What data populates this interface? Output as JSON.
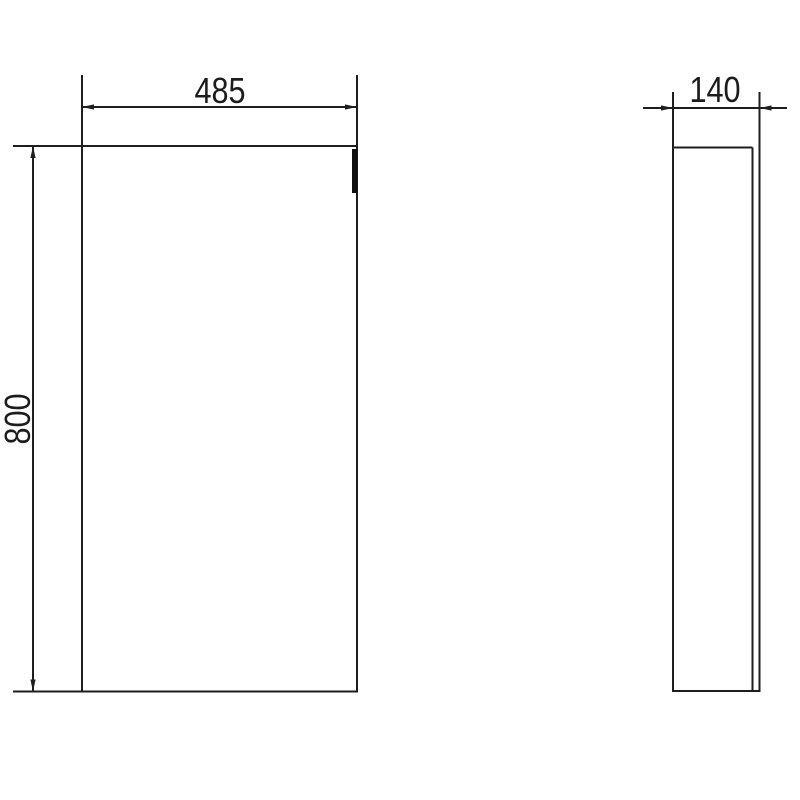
{
  "drawing": {
    "title": "cabinet-two-view-technical-drawing",
    "background_color": "#ffffff",
    "line_color": "#1e1e1e",
    "handle_color": "#0f0f0f",
    "views": {
      "front": {
        "label": "front-elevation"
      },
      "side": {
        "label": "side-elevation"
      }
    },
    "dimensions": {
      "width_mm": "485",
      "height_mm": "800",
      "depth_mm": "140"
    }
  }
}
